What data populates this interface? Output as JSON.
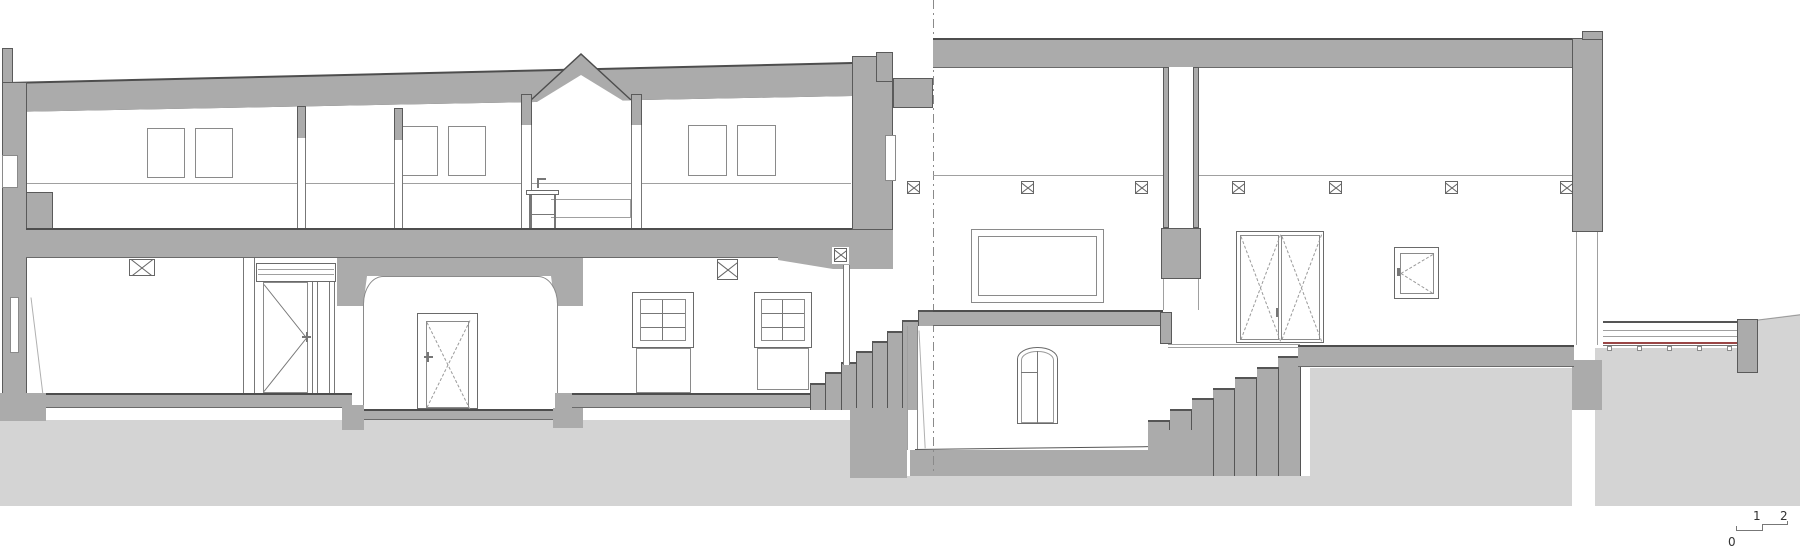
{
  "drawing": {
    "kind": "architectural longitudinal building section",
    "scale_bar": {
      "zero": "0",
      "one": "1",
      "two": "2"
    },
    "annotations": {
      "beam_marker_count": 10
    }
  },
  "colors": {
    "cut_poche": "#ababab",
    "ground_fill": "#d4d4d4",
    "outline_dark": "#4d4d4d",
    "line": "#777777",
    "accent_red": "#9a4646",
    "background": "#ffffff"
  }
}
